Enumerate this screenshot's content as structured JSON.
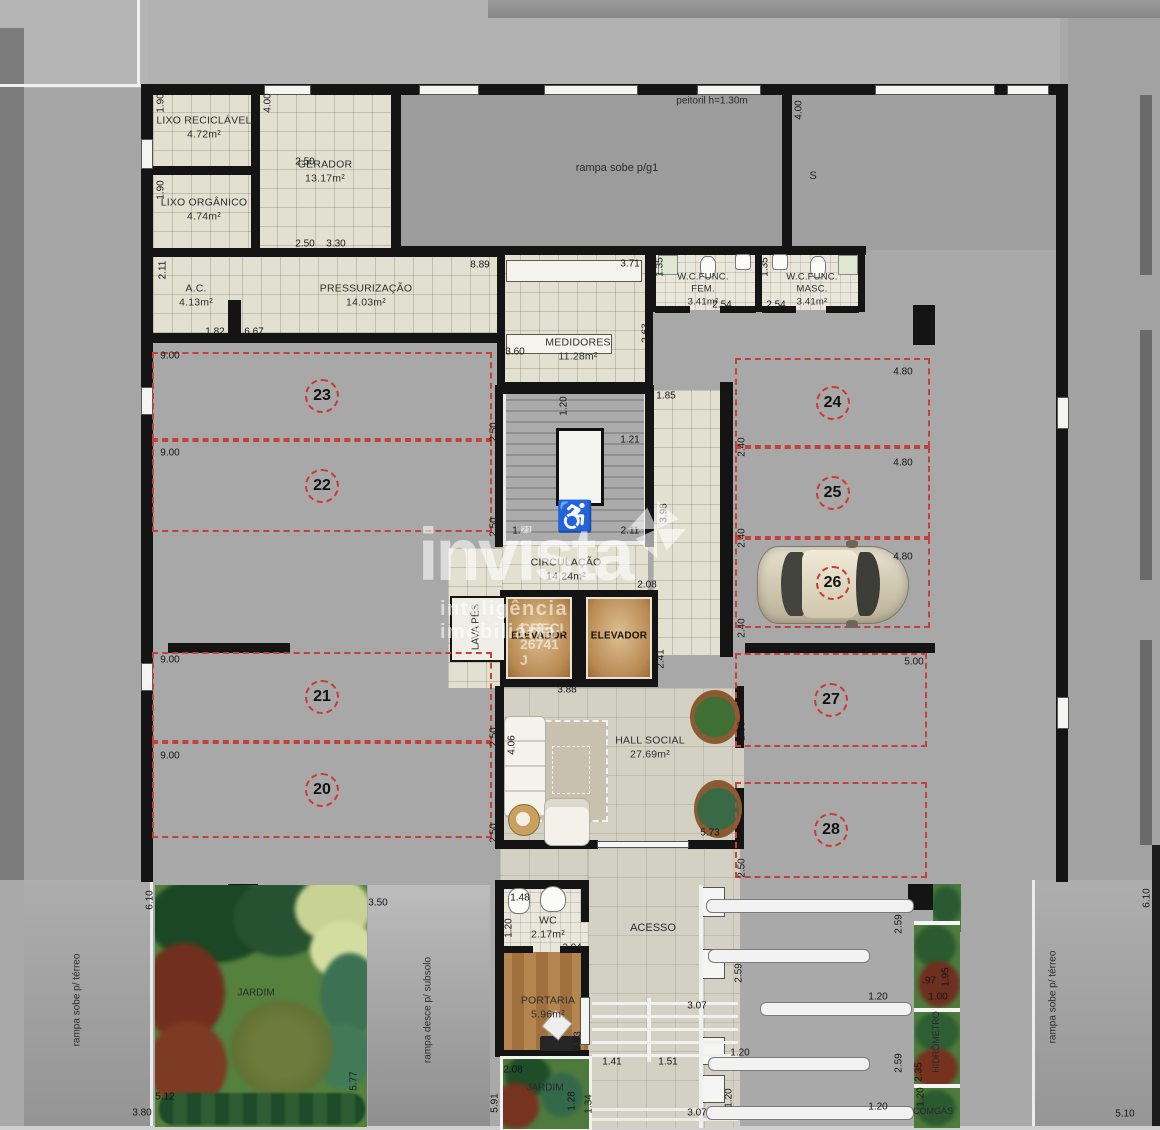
{
  "plan": {
    "brand": {
      "name": "invista",
      "tagline": "inteligência imobiliária",
      "creci": "CRECI 26741 J"
    },
    "rooms": {
      "lixo_reciclavel": {
        "name": "LIXO RECICLÁVEL",
        "area": "4.72m²"
      },
      "gerador": {
        "name": "GERADOR",
        "area": "13.17m²"
      },
      "lixo_organico": {
        "name": "LIXO ORGÂNICO",
        "area": "4.74m²"
      },
      "ac": {
        "name": "A.C.",
        "area": "4.13m²"
      },
      "pressurizacao": {
        "name": "PRESSURIZAÇÃO",
        "area": "14.03m²"
      },
      "medidores": {
        "name": "MEDIDORES",
        "area": "11.28m²"
      },
      "wc_func_fem": {
        "name": "W.C.FUNC. FEM.",
        "area": "3.41m²"
      },
      "wc_func_masc": {
        "name": "W.C.FUNC. MASC.",
        "area": "3.41m²"
      },
      "circulacao": {
        "name": "CIRCULAÇÃO",
        "area": "14.24m²"
      },
      "elevador": {
        "name": "ELEVADOR"
      },
      "lavapes": {
        "name": "LAVA PÉS"
      },
      "hall_social": {
        "name": "HALL SOCIAL",
        "area": "27.69m²"
      },
      "wc": {
        "name": "WC",
        "area": "2.17m²"
      },
      "portaria": {
        "name": "PORTARIA",
        "area": "5.96m²"
      }
    },
    "free_labels": [
      {
        "id": "peitoril",
        "t": "peitoril h=1.30m",
        "x": 712,
        "y": 101,
        "fs": 10
      },
      {
        "id": "rampa-g1",
        "t": "rampa sobe p/g1",
        "x": 617,
        "y": 168,
        "fs": 11
      },
      {
        "id": "s-marker",
        "t": "S",
        "x": 813,
        "y": 176,
        "fs": 11
      },
      {
        "id": "rampa-terreo-left",
        "t": "rampa sobe p/ térreo",
        "x": 77,
        "y": 1000,
        "v": 1,
        "fs": 10
      },
      {
        "id": "rampa-terreo-right",
        "t": "rampa sobe p/ térreo",
        "x": 1053,
        "y": 997,
        "v": 1,
        "fs": 10
      },
      {
        "id": "rampa-subsolo",
        "t": "rampa desce p/ subsolo",
        "x": 428,
        "y": 1010,
        "v": 1,
        "fs": 10
      },
      {
        "id": "acesso",
        "t": "ACESSO",
        "x": 653,
        "y": 928,
        "fs": 11
      },
      {
        "id": "jardim-big",
        "t": "JARDIM",
        "x": 256,
        "y": 993,
        "fs": 10
      },
      {
        "id": "jardim-small",
        "t": "JARDIM",
        "x": 545,
        "y": 1088,
        "fs": 10
      },
      {
        "id": "hidrometro",
        "t": "HIDRÔMETRO",
        "x": 936,
        "y": 1042,
        "v": 1,
        "fs": 9
      },
      {
        "id": "comgas",
        "t": "COMGÁS",
        "x": 933,
        "y": 1111,
        "fs": 9
      }
    ],
    "parking": [
      {
        "num": "23",
        "x": 152,
        "y": 352,
        "w": 340,
        "h": 88
      },
      {
        "num": "22",
        "x": 152,
        "y": 440,
        "w": 340,
        "h": 92
      },
      {
        "num": "21",
        "x": 152,
        "y": 652,
        "w": 340,
        "h": 90
      },
      {
        "num": "20",
        "x": 152,
        "y": 742,
        "w": 340,
        "h": 96
      },
      {
        "num": "24",
        "x": 735,
        "y": 358,
        "w": 195,
        "h": 89
      },
      {
        "num": "25",
        "x": 735,
        "y": 447,
        "w": 195,
        "h": 91
      },
      {
        "num": "26",
        "x": 735,
        "y": 538,
        "w": 195,
        "h": 90
      },
      {
        "num": "27",
        "x": 735,
        "y": 653,
        "w": 192,
        "h": 94
      },
      {
        "num": "28",
        "x": 735,
        "y": 782,
        "w": 192,
        "h": 96
      }
    ],
    "dims": [
      {
        "t": "1.90",
        "x": 161,
        "y": 103,
        "v": 1
      },
      {
        "t": "4.00",
        "x": 268,
        "y": 103,
        "v": 1
      },
      {
        "t": "2.50",
        "x": 305,
        "y": 162
      },
      {
        "t": "1.90",
        "x": 161,
        "y": 190,
        "v": 1
      },
      {
        "t": "2.50",
        "x": 305,
        "y": 244
      },
      {
        "t": "3.30",
        "x": 336,
        "y": 244
      },
      {
        "t": "2.11",
        "x": 163,
        "y": 270,
        "v": 1
      },
      {
        "t": "8.89",
        "x": 480,
        "y": 265
      },
      {
        "t": "1.82",
        "x": 215,
        "y": 332
      },
      {
        "t": "6.67",
        "x": 254,
        "y": 332
      },
      {
        "t": "3.71",
        "x": 630,
        "y": 264
      },
      {
        "t": "4.00",
        "x": 799,
        "y": 110,
        "v": 1
      },
      {
        "t": "1.35",
        "x": 660,
        "y": 267,
        "v": 1
      },
      {
        "t": "2.54",
        "x": 722,
        "y": 305
      },
      {
        "t": "2.54",
        "x": 776,
        "y": 305
      },
      {
        "t": "1.35",
        "x": 765,
        "y": 267,
        "v": 1
      },
      {
        "t": "3.60",
        "x": 515,
        "y": 352
      },
      {
        "t": "2.63",
        "x": 646,
        "y": 333,
        "v": 1
      },
      {
        "t": "9.00",
        "x": 170,
        "y": 356
      },
      {
        "t": "9.00",
        "x": 170,
        "y": 453
      },
      {
        "t": "9.00",
        "x": 170,
        "y": 660
      },
      {
        "t": "9.00",
        "x": 170,
        "y": 756
      },
      {
        "t": "2.50",
        "x": 494,
        "y": 432,
        "v": 1
      },
      {
        "t": "2.50",
        "x": 494,
        "y": 527,
        "v": 1
      },
      {
        "t": "2.50",
        "x": 494,
        "y": 737,
        "v": 1
      },
      {
        "t": "2.50",
        "x": 494,
        "y": 833,
        "v": 1
      },
      {
        "t": "1.20",
        "x": 564,
        "y": 406,
        "v": 1
      },
      {
        "t": "1.21",
        "x": 630,
        "y": 440
      },
      {
        "t": "1.85",
        "x": 666,
        "y": 396
      },
      {
        "t": "11.65",
        "x": 725,
        "y": 406,
        "v": 1
      },
      {
        "t": "1.21",
        "x": 522,
        "y": 531
      },
      {
        "t": "2.11",
        "x": 630,
        "y": 531
      },
      {
        "t": "3.98",
        "x": 664,
        "y": 513,
        "v": 1
      },
      {
        "t": "2.08",
        "x": 647,
        "y": 585
      },
      {
        "t": "2.40",
        "x": 742,
        "y": 447,
        "v": 1
      },
      {
        "t": "2.40",
        "x": 742,
        "y": 538,
        "v": 1
      },
      {
        "t": "2.40",
        "x": 742,
        "y": 628,
        "v": 1
      },
      {
        "t": "4.80",
        "x": 903,
        "y": 372
      },
      {
        "t": "4.80",
        "x": 903,
        "y": 463
      },
      {
        "t": "4.80",
        "x": 903,
        "y": 557
      },
      {
        "t": "5.00",
        "x": 914,
        "y": 662
      },
      {
        "t": "2.41",
        "x": 661,
        "y": 659,
        "v": 1
      },
      {
        "t": "3.88",
        "x": 567,
        "y": 690
      },
      {
        "t": "2.50",
        "x": 742,
        "y": 731,
        "v": 1
      },
      {
        "t": "2.50",
        "x": 742,
        "y": 868,
        "v": 1
      },
      {
        "t": "4.06",
        "x": 512,
        "y": 745,
        "v": 1
      },
      {
        "t": "5.73",
        "x": 710,
        "y": 833
      },
      {
        "t": "6.10",
        "x": 150,
        "y": 900,
        "v": 1
      },
      {
        "t": "6.10",
        "x": 1147,
        "y": 898,
        "v": 1
      },
      {
        "t": "3.50",
        "x": 378,
        "y": 903
      },
      {
        "t": "1.48",
        "x": 520,
        "y": 898
      },
      {
        "t": "1.20",
        "x": 509,
        "y": 928,
        "v": 1
      },
      {
        "t": "2.04",
        "x": 572,
        "y": 948
      },
      {
        "t": "2.93",
        "x": 578,
        "y": 1041,
        "v": 1
      },
      {
        "t": "2.08",
        "x": 513,
        "y": 1070
      },
      {
        "t": "1.28",
        "x": 572,
        "y": 1101,
        "v": 1
      },
      {
        "t": "1.34",
        "x": 589,
        "y": 1104,
        "v": 1
      },
      {
        "t": "5.91",
        "x": 495,
        "y": 1103,
        "v": 1
      },
      {
        "t": "5.12",
        "x": 165,
        "y": 1097
      },
      {
        "t": "5.77",
        "x": 354,
        "y": 1081,
        "v": 1
      },
      {
        "t": "3.80",
        "x": 142,
        "y": 1113
      },
      {
        "t": "1.41",
        "x": 612,
        "y": 1062
      },
      {
        "t": "1.51",
        "x": 668,
        "y": 1062
      },
      {
        "t": "3.07",
        "x": 697,
        "y": 1006
      },
      {
        "t": "3.07",
        "x": 697,
        "y": 1113
      },
      {
        "t": "2.59",
        "x": 899,
        "y": 924,
        "v": 1
      },
      {
        "t": "2.59",
        "x": 739,
        "y": 973,
        "v": 1
      },
      {
        "t": "2.59",
        "x": 899,
        "y": 1063,
        "v": 1
      },
      {
        "t": "1.20",
        "x": 878,
        "y": 997
      },
      {
        "t": "1.20",
        "x": 740,
        "y": 1053
      },
      {
        "t": "1.20",
        "x": 729,
        "y": 1098,
        "v": 1
      },
      {
        "t": "1.20",
        "x": 878,
        "y": 1107
      },
      {
        "t": ".97",
        "x": 929,
        "y": 981
      },
      {
        "t": "1.95",
        "x": 946,
        "y": 977,
        "v": 1
      },
      {
        "t": "1.00",
        "x": 938,
        "y": 997
      },
      {
        "t": "2.35",
        "x": 919,
        "y": 1072,
        "v": 1
      },
      {
        "t": "1.20",
        "x": 921,
        "y": 1097,
        "v": 1
      },
      {
        "t": "5.10",
        "x": 1125,
        "y": 1114
      }
    ],
    "colors": {
      "dash_red": "#c2423a",
      "wall": "#141414",
      "accessible_red": "#c1271f"
    }
  }
}
